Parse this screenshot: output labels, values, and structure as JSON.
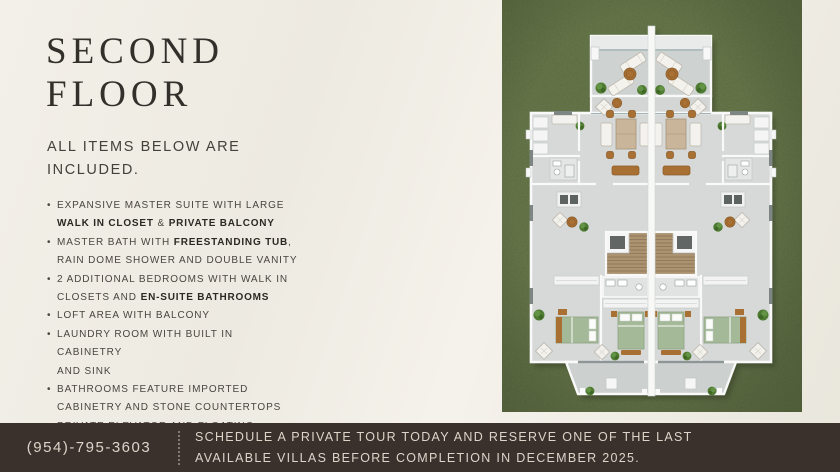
{
  "title": "SECOND FLOOR",
  "subtitle": "ALL ITEMS BELOW ARE\nINCLUDED.",
  "features": [
    {
      "segments": [
        {
          "text": "EXPANSIVE MASTER SUITE WITH LARGE\n"
        },
        {
          "text": "WALK IN CLOSET",
          "bold": true
        },
        {
          "text": " & "
        },
        {
          "text": "PRIVATE BALCONY",
          "bold": true
        }
      ]
    },
    {
      "segments": [
        {
          "text": "MASTER BATH WITH "
        },
        {
          "text": "FREESTANDING TUB",
          "bold": true
        },
        {
          "text": ",\nRAIN DOME SHOWER AND DOUBLE VANITY"
        }
      ]
    },
    {
      "segments": [
        {
          "text": "2 ADDITIONAL BEDROOMS WITH WALK IN\nCLOSETS AND "
        },
        {
          "text": "EN-SUITE BATHROOMS",
          "bold": true
        }
      ]
    },
    {
      "segments": [
        {
          "text": "LOFT AREA WITH BALCONY"
        }
      ]
    },
    {
      "segments": [
        {
          "text": "LAUNDRY ROOM WITH BUILT IN CABINETRY\nAND SINK"
        }
      ]
    },
    {
      "segments": [
        {
          "text": "BATHROOMS FEATURE IMPORTED\nCABINETRY AND STONE COUNTERTOPS"
        }
      ]
    },
    {
      "segments": [
        {
          "text": "PRIVATE ELEVATOR AND FLOATING\nSTAIRCASE"
        }
      ]
    }
  ],
  "floor_plan": {
    "description": "Aerial rendering of the second floor of two mirrored twin villas on grass: top terrace with sun loungers, master suites, stairs with elevator, two additional bedrooms per villa, rear balcony"
  },
  "footer": {
    "phone": "(954)-795-3603",
    "cta": "SCHEDULE A PRIVATE TOUR TODAY AND RESERVE ONE OF THE LAST\nAVAILABLE VILLAS BEFORE COMPLETION IN DECEMBER 2025."
  },
  "colors": {
    "background": "#f0ede4",
    "heading": "#33302b",
    "text": "#4a453f",
    "bold_text": "#2c2924",
    "grass": "#5c6c41",
    "plan_floor": "#d6d9d8",
    "banner_bg": "#3a312c",
    "banner_text": "#ddd5c9"
  }
}
